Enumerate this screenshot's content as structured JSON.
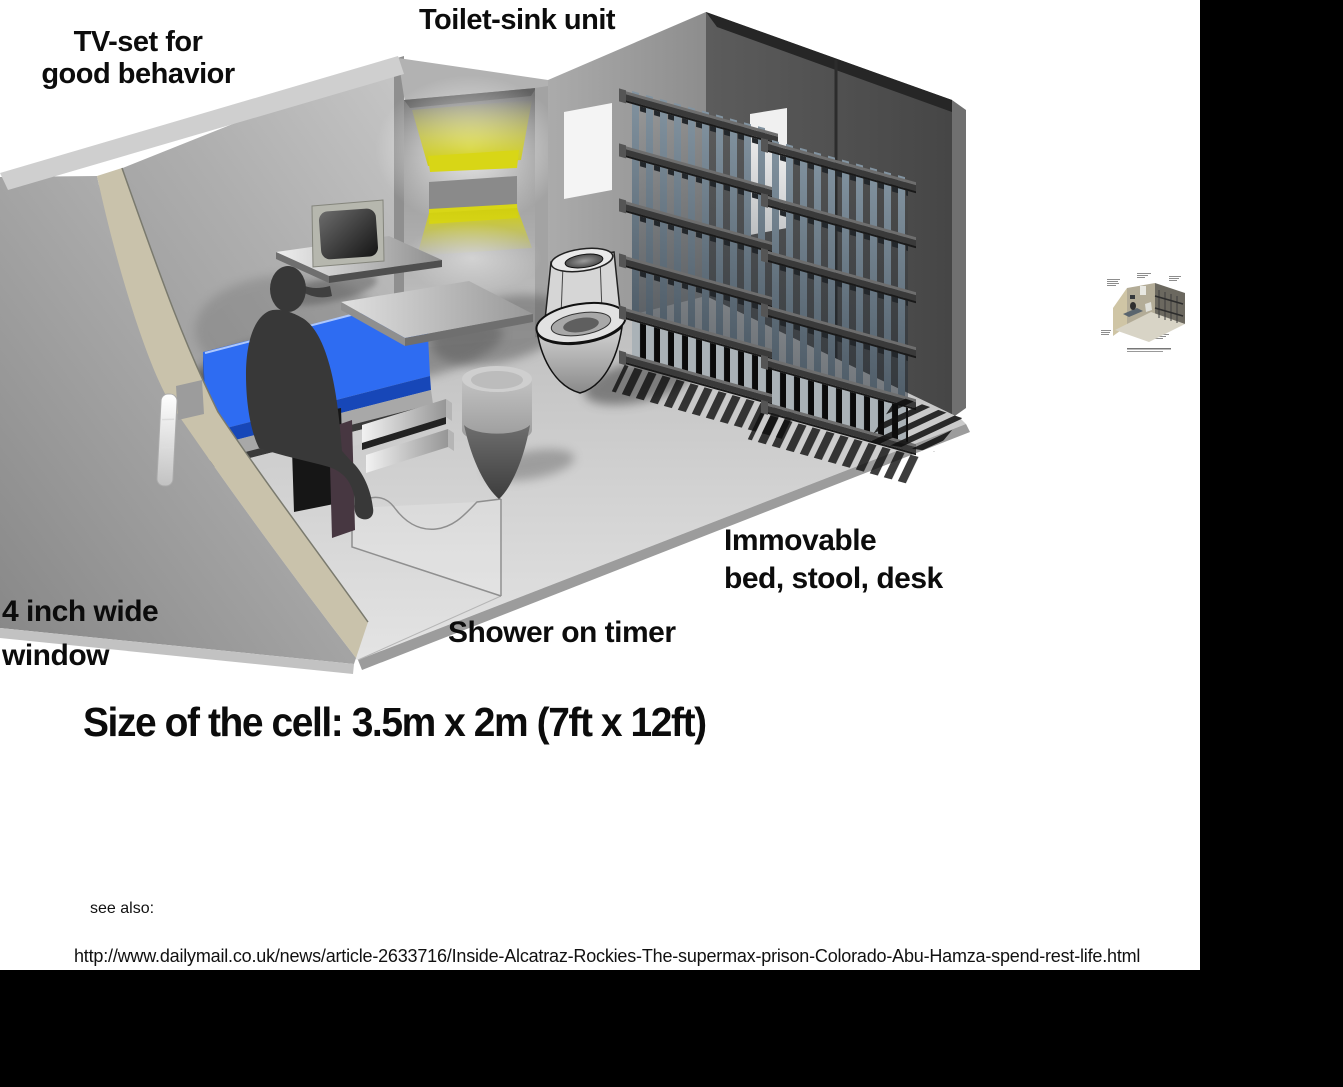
{
  "canvas": {
    "width": 1343,
    "height": 1087,
    "background": "#ffffff",
    "letterbox": "#000000"
  },
  "diagram": {
    "annotations": {
      "tv": {
        "line1": "TV-set for",
        "line2": "good behavior"
      },
      "toilet_sink": "Toilet-sink unit",
      "window": {
        "line1": "4 inch wide",
        "line2": "window"
      },
      "shower": "Shower on timer",
      "furniture": {
        "line1": "Immovable",
        "line2": "bed, stool, desk"
      },
      "cell_size": "Size of the cell: 3.5m x 2m (7ft x 12ft)"
    },
    "colors": {
      "mattress": "#2e6cf2",
      "mattress_edge": "#1747b8",
      "glow": "#d8d616",
      "wall_cut_edge": "#c9c2ab",
      "bars": "#8293a0",
      "dark_wall": "#4f4f4f",
      "floor_light": "#e2e2e2",
      "silhouette": "#383838"
    },
    "scene_elements": [
      "prison-cell-cutaway",
      "bed",
      "prisoner-silhouette",
      "tv-set",
      "wall-shelf",
      "desk",
      "stool",
      "toilet-sink-unit",
      "cell-bars",
      "door-slot",
      "window-slit",
      "shower-tray",
      "wall-lights"
    ]
  },
  "footer": {
    "see_also": "see also:",
    "url": "http://www.dailymail.co.uk/news/article-2633716/Inside-Alcatraz-Rockies-The-supermax-prison-Colorado-Abu-Hamza-spend-rest-life.html"
  }
}
